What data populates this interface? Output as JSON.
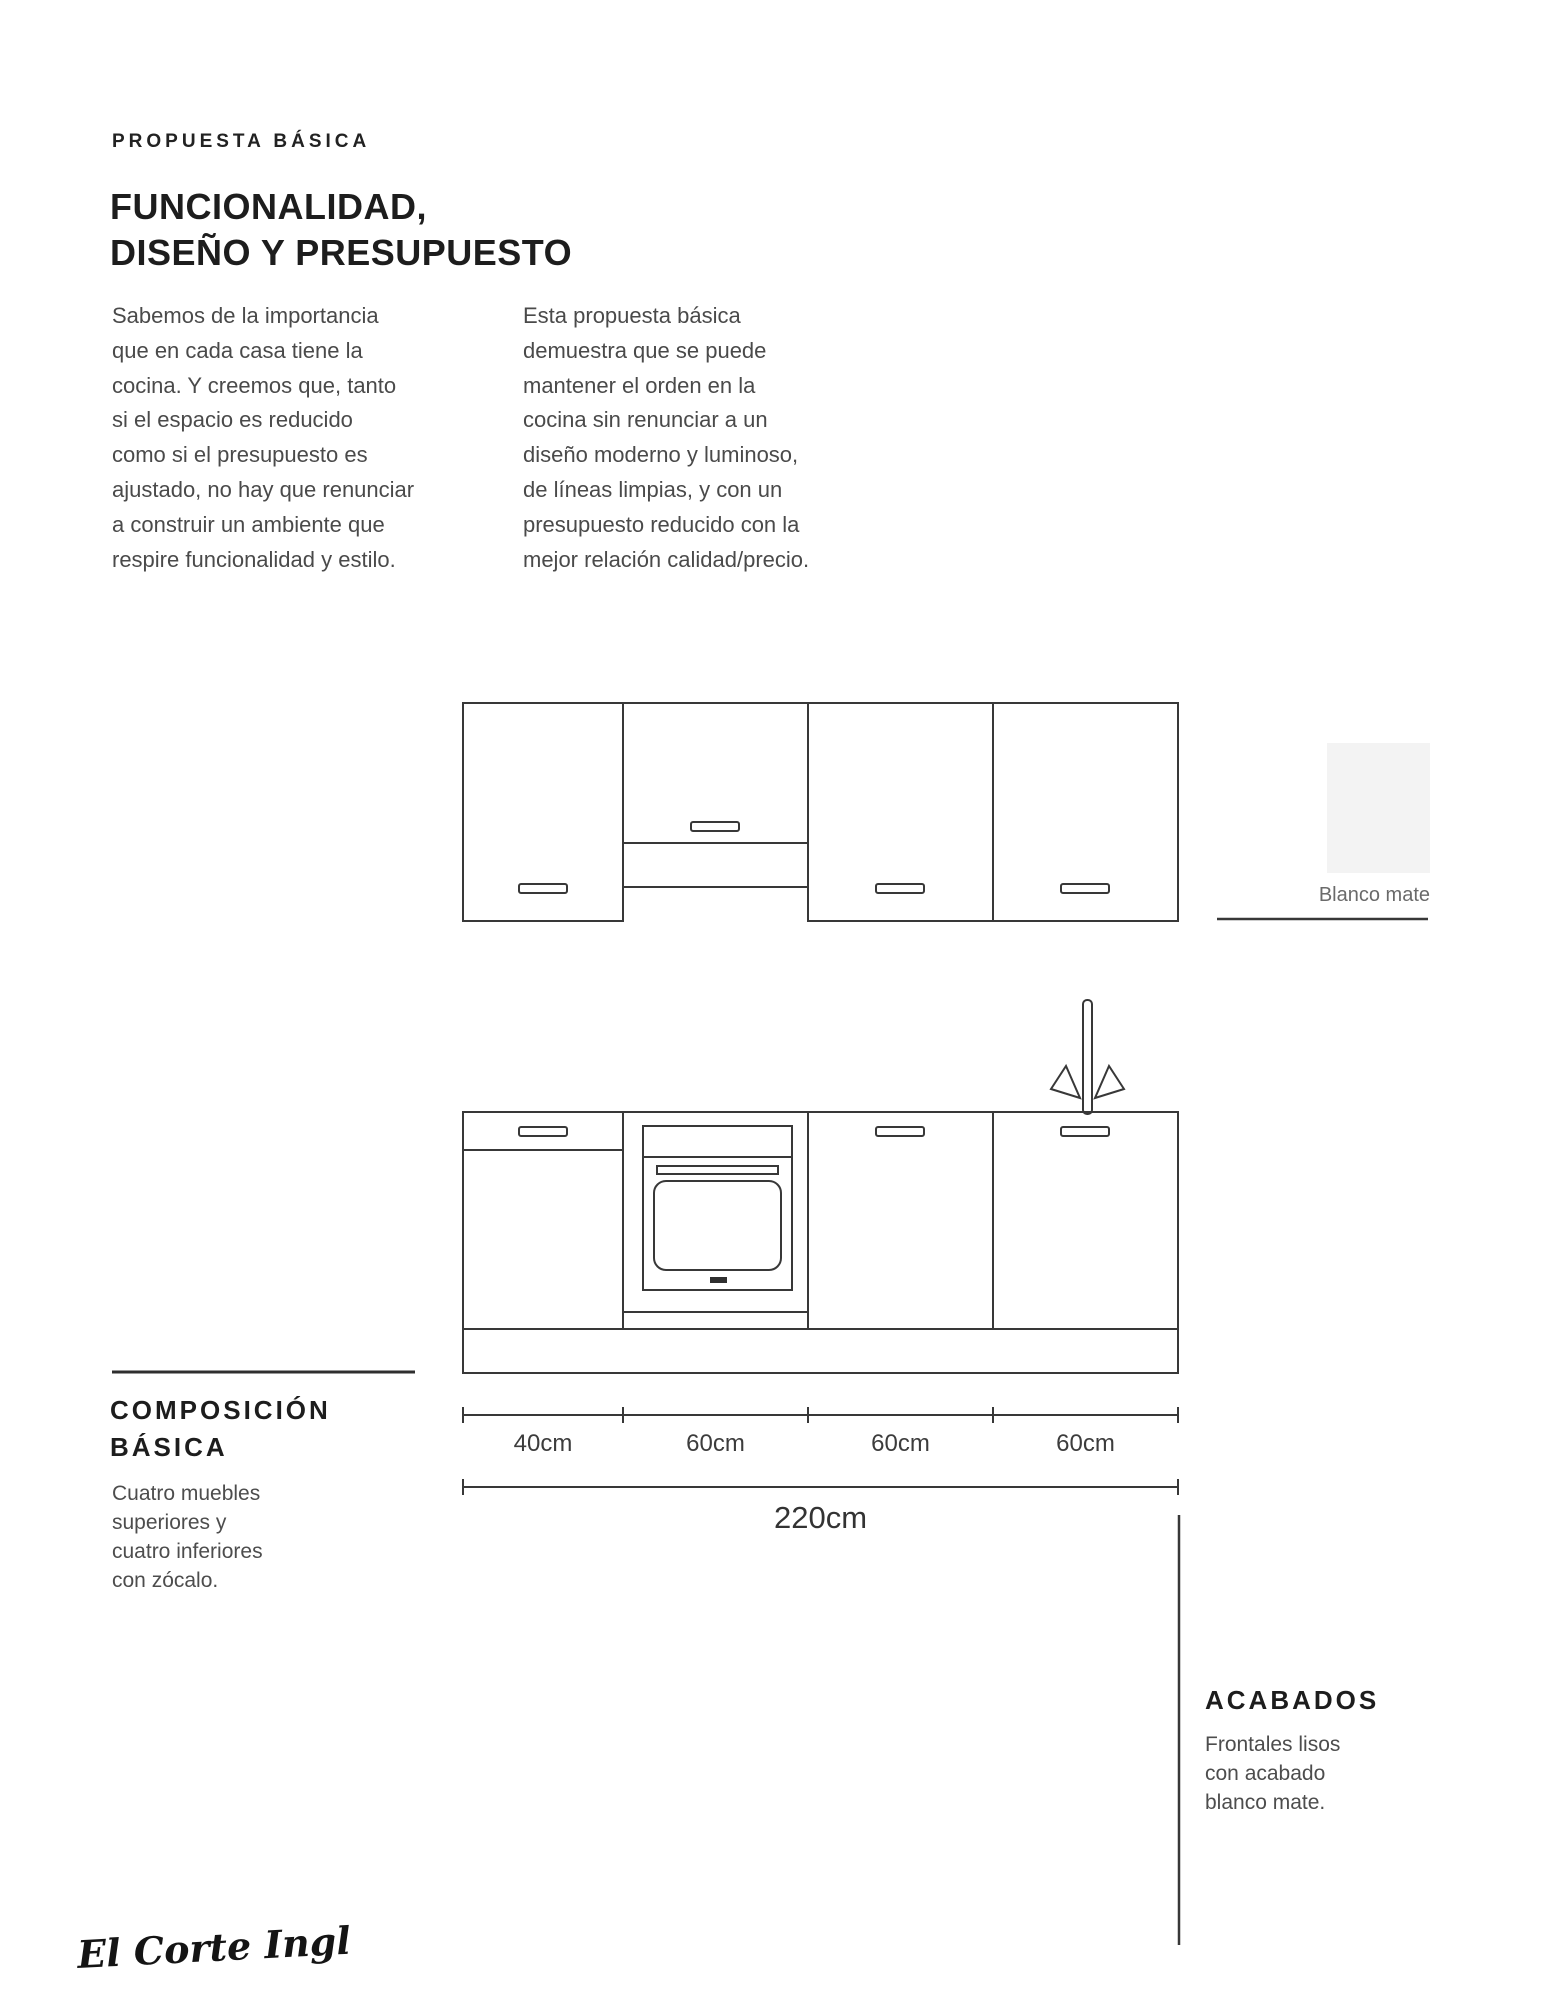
{
  "header": {
    "eyebrow": "PROPUESTA BÁSICA",
    "title_line1": "FUNCIONALIDAD,",
    "title_line2": "DISEÑO Y PRESUPUESTO",
    "intro_col1": "Sabemos de la importancia\nque en cada casa tiene la\ncocina. Y creemos que, tanto\nsi el espacio es reducido\ncomo si el presupuesto es\najustado, no hay que renunciar\na construir un ambiente que\nrespire funcionalidad y estilo.",
    "intro_col2": "Esta propuesta básica\ndemuestra que se puede\nmantener el orden en la\ncocina sin renunciar a un\ndiseño moderno y luminoso,\nde líneas limpias, y con un\npresupuesto reducido con la\nmejor relación calidad/precio."
  },
  "finish_swatch": {
    "label": "Blanco mate",
    "color": "#f3f3f3"
  },
  "composition": {
    "heading_line1": "COMPOSICIÓN",
    "heading_line2": "BÁSICA",
    "body": "Cuatro muebles\nsuperiores y\ncuatro inferiores\ncon zócalo."
  },
  "acabados": {
    "heading": "ACABADOS",
    "body": "Frontales lisos\ncon acabado\nblanco mate."
  },
  "dimensions": {
    "segments": [
      "40cm",
      "60cm",
      "60cm",
      "60cm"
    ],
    "total": "220cm"
  },
  "logo": {
    "text": "El Corte Inglés"
  },
  "colors": {
    "line": "#383838",
    "heading_text": "#1d1d1d",
    "body_text": "#4a4a4a",
    "swatch": "#f3f3f3"
  }
}
